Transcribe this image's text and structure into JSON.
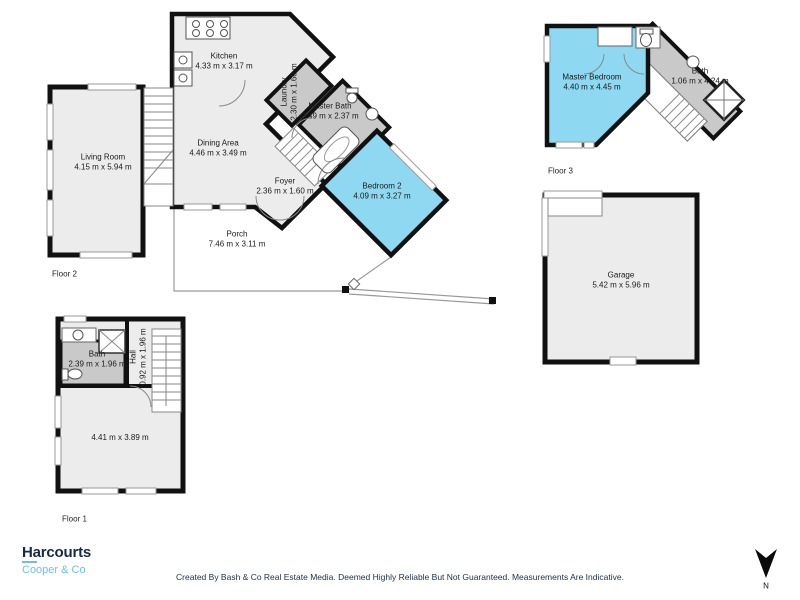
{
  "colors": {
    "wall": "#111111",
    "floor_fill": "#ececec",
    "wet_room_fill": "#c9c9c9",
    "highlight_fill": "#8ed8f2",
    "brand_navy": "#15294d",
    "brand_blue": "#6ec0e8"
  },
  "floor_labels": {
    "floor1": "Floor 1",
    "floor2": "Floor 2",
    "floor3": "Floor 3"
  },
  "rooms": {
    "living": {
      "name": "Living Room",
      "dims": "4.15 m x 5.94 m"
    },
    "kitchen": {
      "name": "Kitchen",
      "dims": "4.33 m x 3.17 m"
    },
    "dining": {
      "name": "Dining Area",
      "dims": "4.46 m x 3.49 m"
    },
    "laundry": {
      "name": "Laundry",
      "dims": "2.30 m x 1.60 m"
    },
    "master_bath": {
      "name": "Master Bath",
      "dims": "2.49 m x 2.37 m"
    },
    "foyer": {
      "name": "Foyer",
      "dims": "2.36 m x 1.60 m"
    },
    "bedroom2": {
      "name": "Bedroom 2",
      "dims": "4.09 m x 3.27 m"
    },
    "porch": {
      "name": "Porch",
      "dims": "7.46 m x 3.11 m"
    },
    "master_bedroom": {
      "name": "Master Bedroom",
      "dims": "4.40 m x 4.45 m"
    },
    "bath_floor3": {
      "name": "Bath",
      "dims": "1.06 m x 4.24 m"
    },
    "garage": {
      "name": "Garage",
      "dims": "5.42 m x 5.96 m"
    },
    "bath_floor1": {
      "name": "Bath",
      "dims": "2.39 m x 1.96 m"
    },
    "hall": {
      "name": "Hall",
      "dims": "0.92 m x 1.96 m"
    },
    "room_floor1": {
      "name": "",
      "dims": "4.41 m x 3.89 m"
    }
  },
  "branding": {
    "agency": "Harcourts",
    "office": "Cooper & Co"
  },
  "compass": {
    "label": "N"
  },
  "footer": {
    "text": "Created By Bash & Co Real Estate Media. Deemed Highly Reliable But Not Guaranteed. Measurements Are Indicative."
  }
}
